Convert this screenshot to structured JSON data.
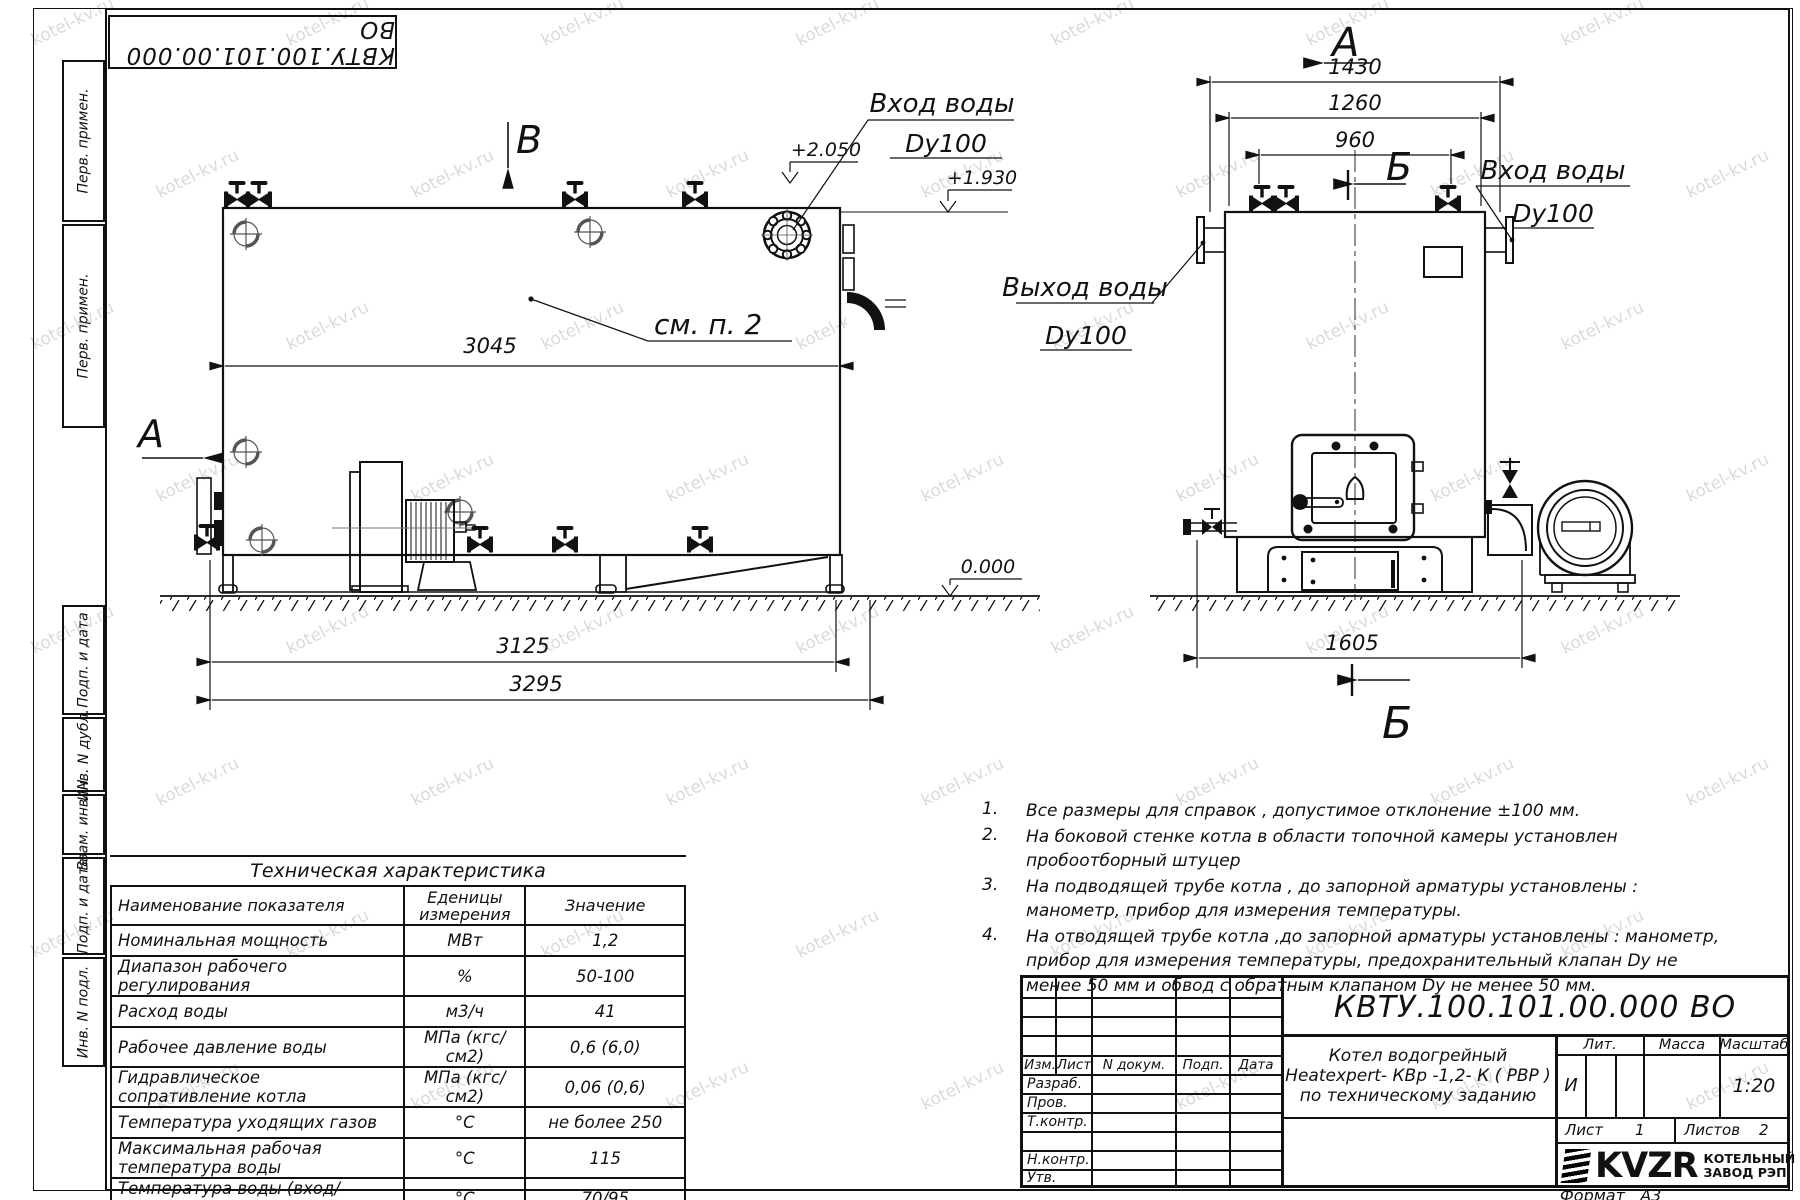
{
  "watermark": "kotel-kv.ru",
  "frame": {
    "stamp": "КВТУ.100.101.00.000  ВО",
    "strips": [
      "Перв. примен.",
      "Перв. примен.",
      "Подп. и дата",
      "Инв. N дубл.",
      "Взам. инв. N",
      "Подп. и дата",
      "Инв. N подл."
    ],
    "format_label": "Формат",
    "format_value": "А3"
  },
  "lv": {
    "a": "А",
    "b": "В",
    "see": "см. п. 2",
    "d3045": "3045",
    "d3125": "3125",
    "d3295": "3295",
    "e2050": "+2.050",
    "e1930": "+1.930",
    "e0": "0.000",
    "in1": "Вход воды",
    "in2": "Dy100"
  },
  "rv": {
    "a": "А",
    "b": "Б",
    "d1430": "1430",
    "d1260": "1260",
    "d960": "960",
    "d1605": "1605",
    "out1": "Выход воды",
    "out2": "Dy100",
    "in1": "Вход воды",
    "in2": "Dy100"
  },
  "notes": [
    {
      "num": "1.",
      "text": "Все размеры для справок , допустимое отклонение  ±100 мм."
    },
    {
      "num": "2.",
      "text": "На боковой стенке котла в области топочной камеры установлен пробоотборный штуцер"
    },
    {
      "num": "3.",
      "text": "На   подводящей трубе котла , до запорной арматуры установлены : манометр, прибор для измерения температуры."
    },
    {
      "num": "4.",
      "text": "На отводящей трубе котла ,до запорной арматуры установлены : манометр, прибор для измерения температуры, предохранительный клапан  Dу не менее  50 мм и обвод с обратным клапаном  Dу не менее  50 мм."
    }
  ],
  "table": {
    "title": "Техническая характеристика",
    "h_name": "Наименование показателя",
    "h_units1": "Еденицы",
    "h_units2": "измерения",
    "h_value": "Значение",
    "rows": [
      {
        "n": "Номинальная мощность",
        "u": "МВт",
        "v": "1,2"
      },
      {
        "n": "Диапазон рабочего регулирования",
        "u": "%",
        "v": "50-100"
      },
      {
        "n": "Расход воды",
        "u": "м3/ч",
        "v": "41"
      },
      {
        "n": "Рабочее давление воды",
        "u": "МПа (кгс/см2)",
        "v": "0,6 (6,0)"
      },
      {
        "n": "Гидравлическое сопративление котла",
        "u": "МПа (кгс/см2)",
        "v": "0,06 (0,6)"
      },
      {
        "n": "Температура уходящих газов",
        "u": "°С",
        "v": "не более 250"
      },
      {
        "n": "Максимальная рабочая температура воды",
        "u": "°С",
        "v": "115"
      },
      {
        "n": "Температура воды (вход/выход)",
        "u": "°С",
        "v": "70/95"
      },
      {
        "n": "Габариты котла (длинна х ширина х высота)",
        "u": "мм",
        "v": "3295х1605х2050"
      }
    ]
  },
  "tb": {
    "doc": "КВТУ.100.101.00.000  ВО",
    "cols": [
      "Изм.",
      "Лист",
      "N докум.",
      "Подп.",
      "Дата"
    ],
    "rows": [
      "Разраб.",
      "Пров.",
      "Т.контр.",
      "",
      "Н.контр.",
      "Утв."
    ],
    "name1": "Котел водогрейный",
    "name2": "Heatexpert- КВр -1,2- К ( РВР )",
    "name3": "по техническому заданию",
    "lit": "Лит.",
    "litv": "И",
    "mass": "Масса",
    "scale": "Масштаб",
    "scalev": "1:20",
    "sheet": "Лист",
    "sheetv": "1",
    "sheets": "Листов",
    "sheetsv": "2",
    "logo": "KVZR",
    "co1": "КОТЕЛЬНЫЙ",
    "co2": "ЗАВОД РЭП"
  }
}
